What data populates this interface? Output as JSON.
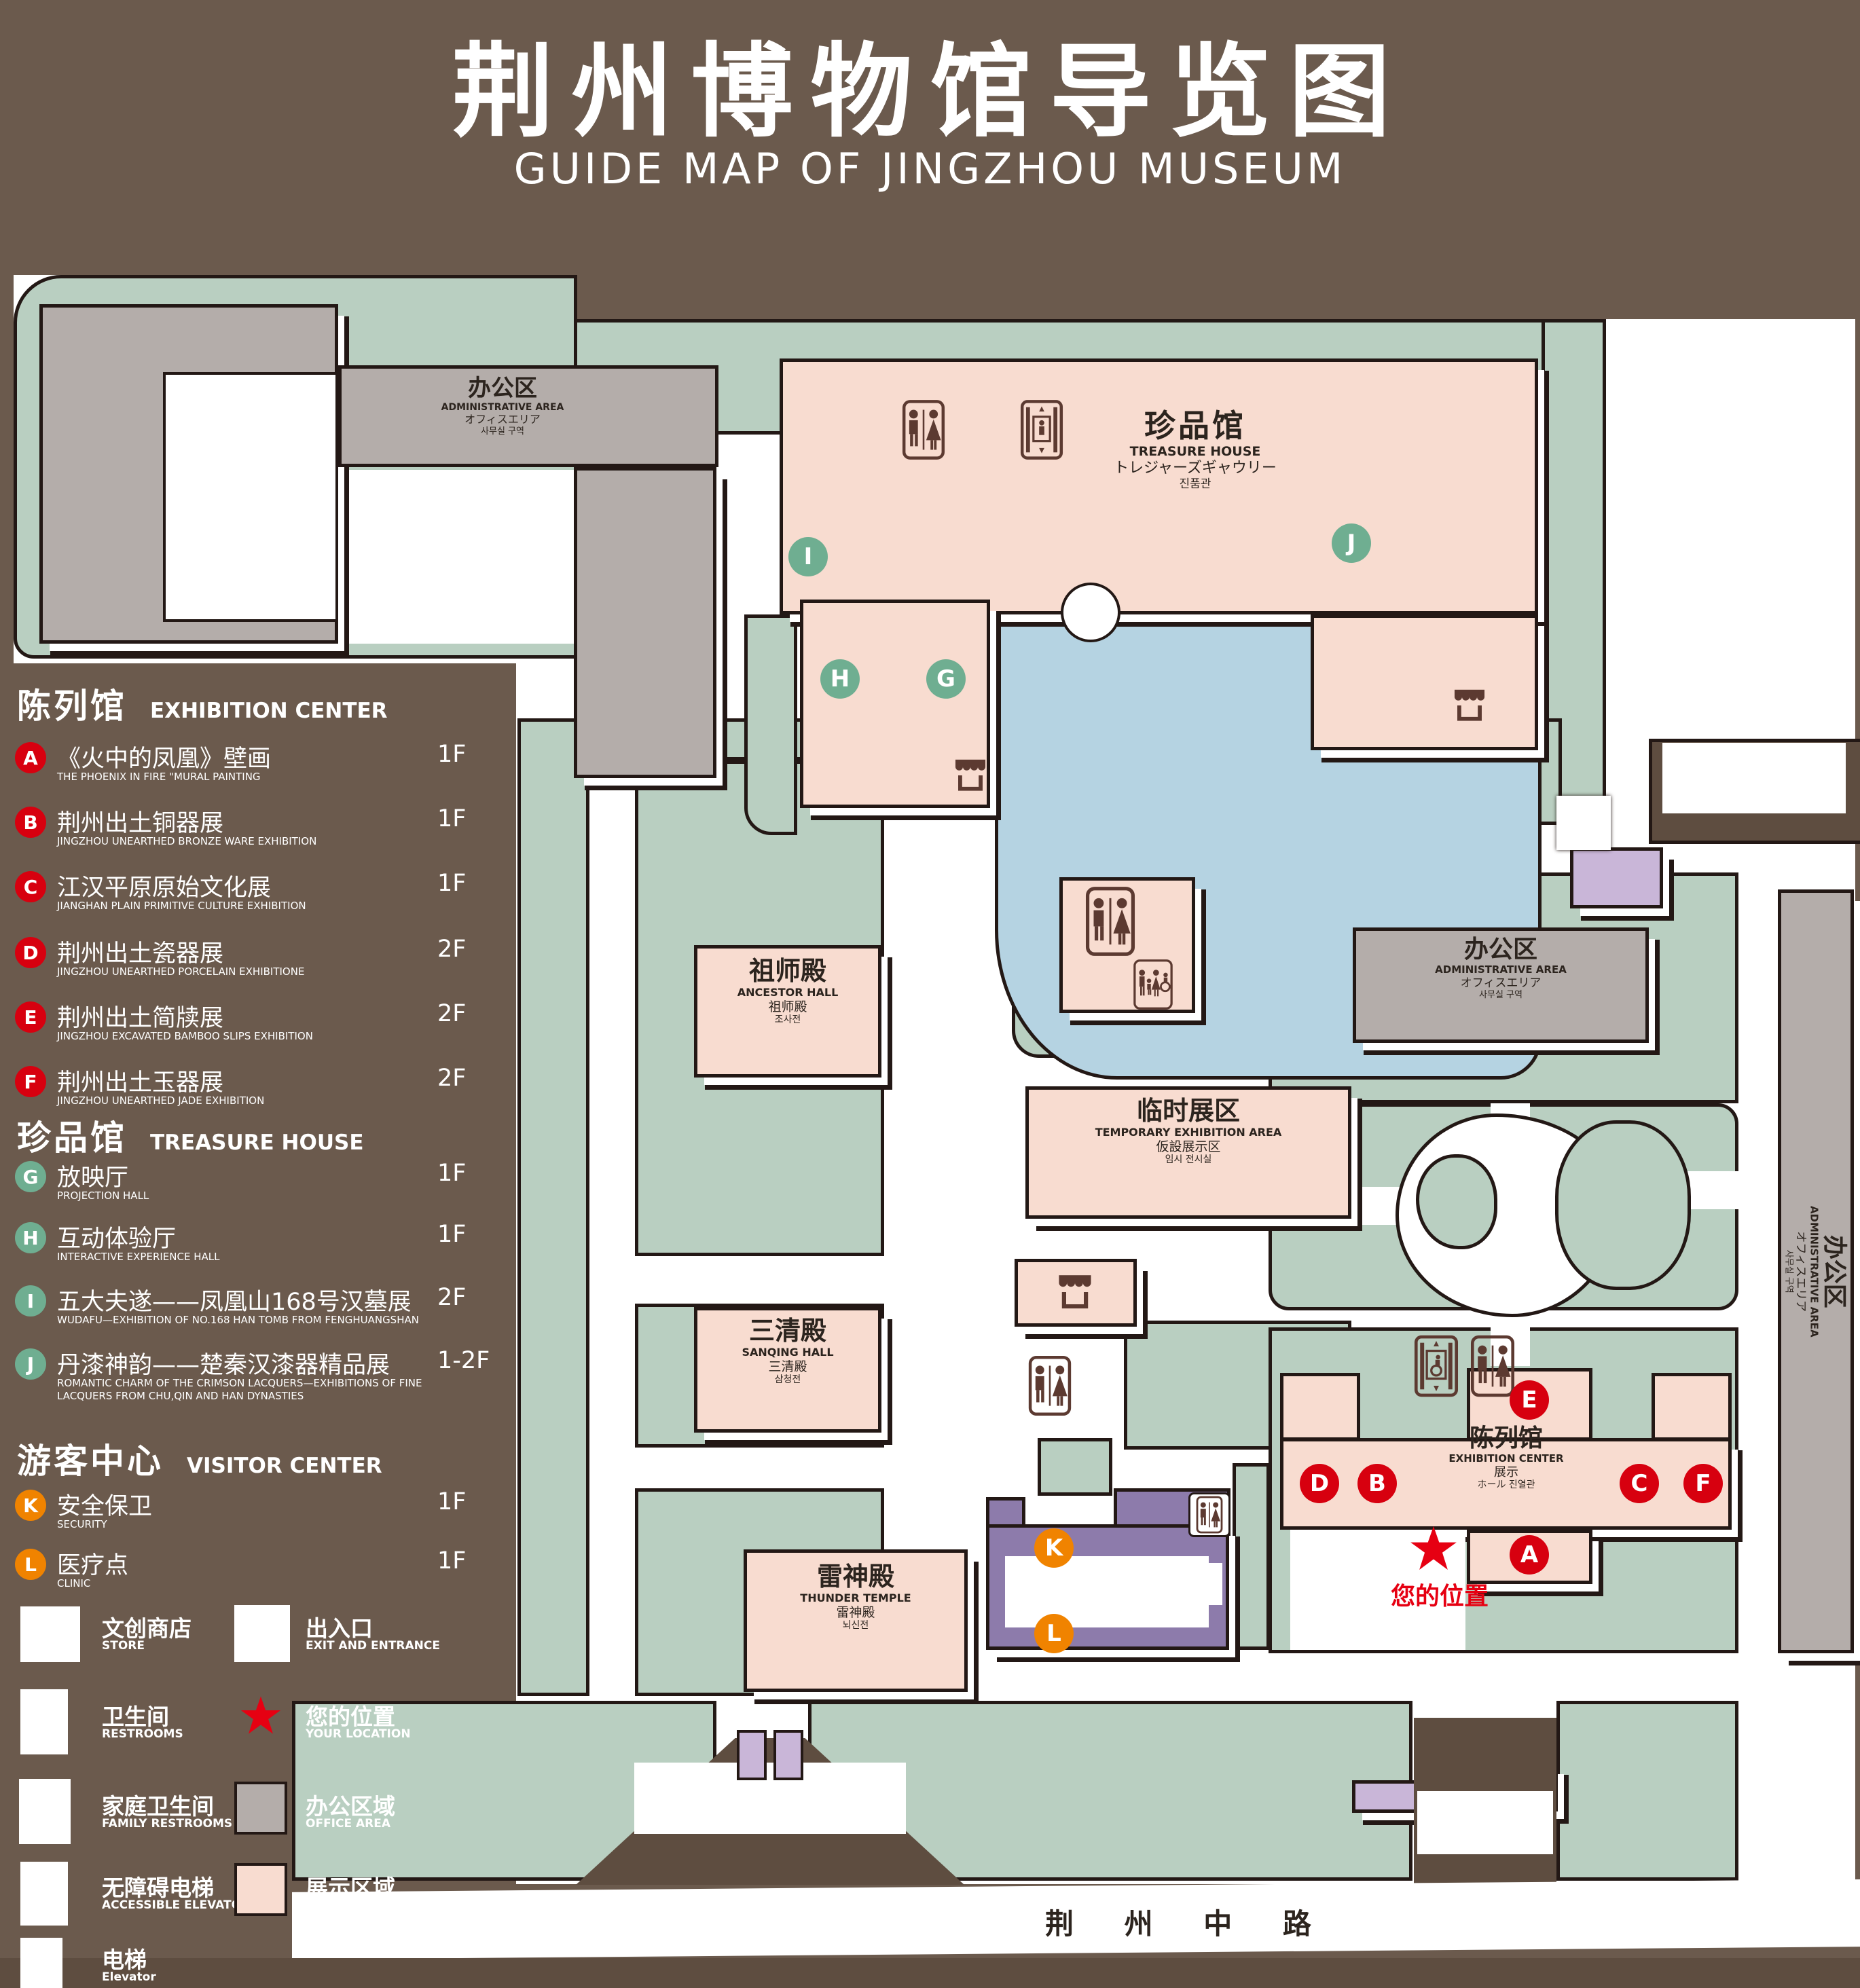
{
  "title": {
    "zh": "荆州博物馆导览图",
    "en": "GUIDE MAP OF JINGZHOU MUSEUM"
  },
  "colors": {
    "background": "#6b5a4d",
    "dark_brown": "#5e4d40",
    "park_green": "#b9cfc1",
    "display_pink": "#f8dcd0",
    "office_gray": "#b4adaa",
    "lake_blue": "#b5d3e2",
    "visitor_purple": "#8d7bab",
    "light_purple": "#c9b6d8",
    "outline": "#231815",
    "marker_red": "#d7000f",
    "marker_green": "#6fae91",
    "marker_orange": "#f08300",
    "star_red": "#e60012"
  },
  "legend": {
    "sections": [
      {
        "zh": "陈列馆",
        "en": "EXHIBITION CENTER",
        "items": [
          {
            "letter": "A",
            "zh": "《火中的凤凰》壁画",
            "en": "THE PHOENIX IN FIRE \"MURAL PAINTING",
            "floor": "1F"
          },
          {
            "letter": "B",
            "zh": "荆州出土铜器展",
            "en": "JINGZHOU UNEARTHED BRONZE WARE EXHIBITION",
            "floor": "1F"
          },
          {
            "letter": "C",
            "zh": "江汉平原原始文化展",
            "en": "JIANGHAN PLAIN PRIMITIVE CULTURE EXHIBITION",
            "floor": "1F"
          },
          {
            "letter": "D",
            "zh": "荆州出土瓷器展",
            "en": "JINGZHOU UNEARTHED PORCELAIN EXHIBITIONE",
            "floor": "2F"
          },
          {
            "letter": "E",
            "zh": "荆州出土简牍展",
            "en": "JINGZHOU EXCAVATED BAMBOO SLIPS EXHIBITION",
            "floor": "2F"
          },
          {
            "letter": "F",
            "zh": "荆州出土玉器展",
            "en": "JINGZHOU UNEARTHED JADE EXHIBITION",
            "floor": "2F"
          }
        ]
      },
      {
        "zh": "珍品馆",
        "en": "TREASURE HOUSE",
        "items": [
          {
            "letter": "G",
            "zh": "放映厅",
            "en": "PROJECTION HALL",
            "floor": "1F"
          },
          {
            "letter": "H",
            "zh": "互动体验厅",
            "en": "INTERACTIVE EXPERIENCE HALL",
            "floor": "1F"
          },
          {
            "letter": "I",
            "zh": "五大夫遂——凤凰山168号汉墓展",
            "en": "WUDAFU—EXHIBITION OF NO.168 HAN TOMB FROM FENGHUANGSHAN",
            "floor": "2F"
          },
          {
            "letter": "J",
            "zh": "丹漆神韵——楚秦汉漆器精品展",
            "en": "ROMANTIC CHARM OF THE CRIMSON LACQUERS—EXHIBITIONS OF FINE LACQUERS FROM CHU,QIN AND HAN DYNASTIES",
            "floor": "1-2F"
          }
        ]
      },
      {
        "zh": "游客中心",
        "en": "VISITOR CENTER",
        "items": [
          {
            "letter": "K",
            "zh": "安全保卫",
            "en": "SECURITY",
            "floor": "1F"
          },
          {
            "letter": "L",
            "zh": "医疗点",
            "en": "CLINIC",
            "floor": "1F"
          }
        ]
      }
    ],
    "icon_items": [
      {
        "icon": "store-icon",
        "zh": "文创商店",
        "en": "STORE"
      },
      {
        "icon": "exit-icon",
        "zh": "出入口",
        "en": "EXIT AND ENTRANCE"
      },
      {
        "icon": "restroom-icon",
        "zh": "卫生间",
        "en": "RESTROOMS"
      },
      {
        "icon": "location-star-icon",
        "zh": "您的位置",
        "en": "YOUR LOCATION"
      },
      {
        "icon": "family-restroom-icon",
        "zh": "家庭卫生间",
        "en": "FAMILY RESTROOMS"
      },
      {
        "icon": "office-area-swatch",
        "zh": "办公区域",
        "en": "OFFICE AREA"
      },
      {
        "icon": "accessible-elevator-icon",
        "zh": "无障碍电梯",
        "en": "ACCESSIBLE ELEVATOR"
      },
      {
        "icon": "display-area-swatch",
        "zh": "展示区域",
        "en": "DISPLAY AREA"
      },
      {
        "icon": "elevator-icon",
        "zh": "电梯",
        "en": "Elevator"
      }
    ]
  },
  "map": {
    "treasure_house": {
      "zh": "珍品馆",
      "en": "TREASURE HOUSE",
      "ja": "トレジャーズギャウリー",
      "ko": "진품관"
    },
    "admin_area": {
      "zh": "办公区",
      "en": "ADMINISTRATIVE AREA",
      "ja": "オフィスエリア",
      "ko": "사무실 구역"
    },
    "ancestor_hall": {
      "zh": "祖师殿",
      "en": "ANCESTOR HALL",
      "zh2": "祖师殿",
      "ko": "조사전"
    },
    "sanqing_hall": {
      "zh": "三清殿",
      "en": "SANQING HALL",
      "zh2": "三清殿",
      "ko": "삼청전"
    },
    "thunder_temple": {
      "zh": "雷神殿",
      "en": "THUNDER TEMPLE",
      "zh2": "雷神殿",
      "ko": "뇌신전"
    },
    "temporary_exhibition": {
      "zh": "临时展区",
      "en": "TEMPORARY EXHIBITION AREA",
      "ja": "仮設展示区",
      "ko": "임시 전시실"
    },
    "exhibition_center": {
      "zh": "陈列馆",
      "en": "EXHIBITION CENTER",
      "zh2": "展示",
      "ja_ko": "ホール 진열관"
    },
    "visitor_center": {
      "zh": "游客中心",
      "en": "VISITOR CENTER",
      "ja": "ビジターセンター",
      "ko": "관광객 센터"
    },
    "kaiyuan_gate": {
      "zh": "开元观山门",
      "en": "KAIYUAN TEMPLE GATE",
      "ja": "開元観山門",
      "ko": "산문을 열다"
    },
    "exit_top": {
      "zh": "出入口",
      "en": "EXIT AND ENTRANCE",
      "zh2": "出入口",
      "ko": "출입구"
    },
    "exit_bottom": {
      "zh": "出入口",
      "en": "EXIT AND ENTRANCE",
      "zh2": "出入口",
      "ko": "출입구"
    },
    "road": {
      "name": "荆 州 中 路"
    },
    "your_location": {
      "zh": "您的位置"
    },
    "markers": [
      {
        "letter": "A"
      },
      {
        "letter": "B"
      },
      {
        "letter": "C"
      },
      {
        "letter": "D"
      },
      {
        "letter": "E"
      },
      {
        "letter": "F"
      },
      {
        "letter": "G"
      },
      {
        "letter": "H"
      },
      {
        "letter": "I"
      },
      {
        "letter": "J"
      },
      {
        "letter": "K"
      },
      {
        "letter": "L"
      }
    ]
  }
}
